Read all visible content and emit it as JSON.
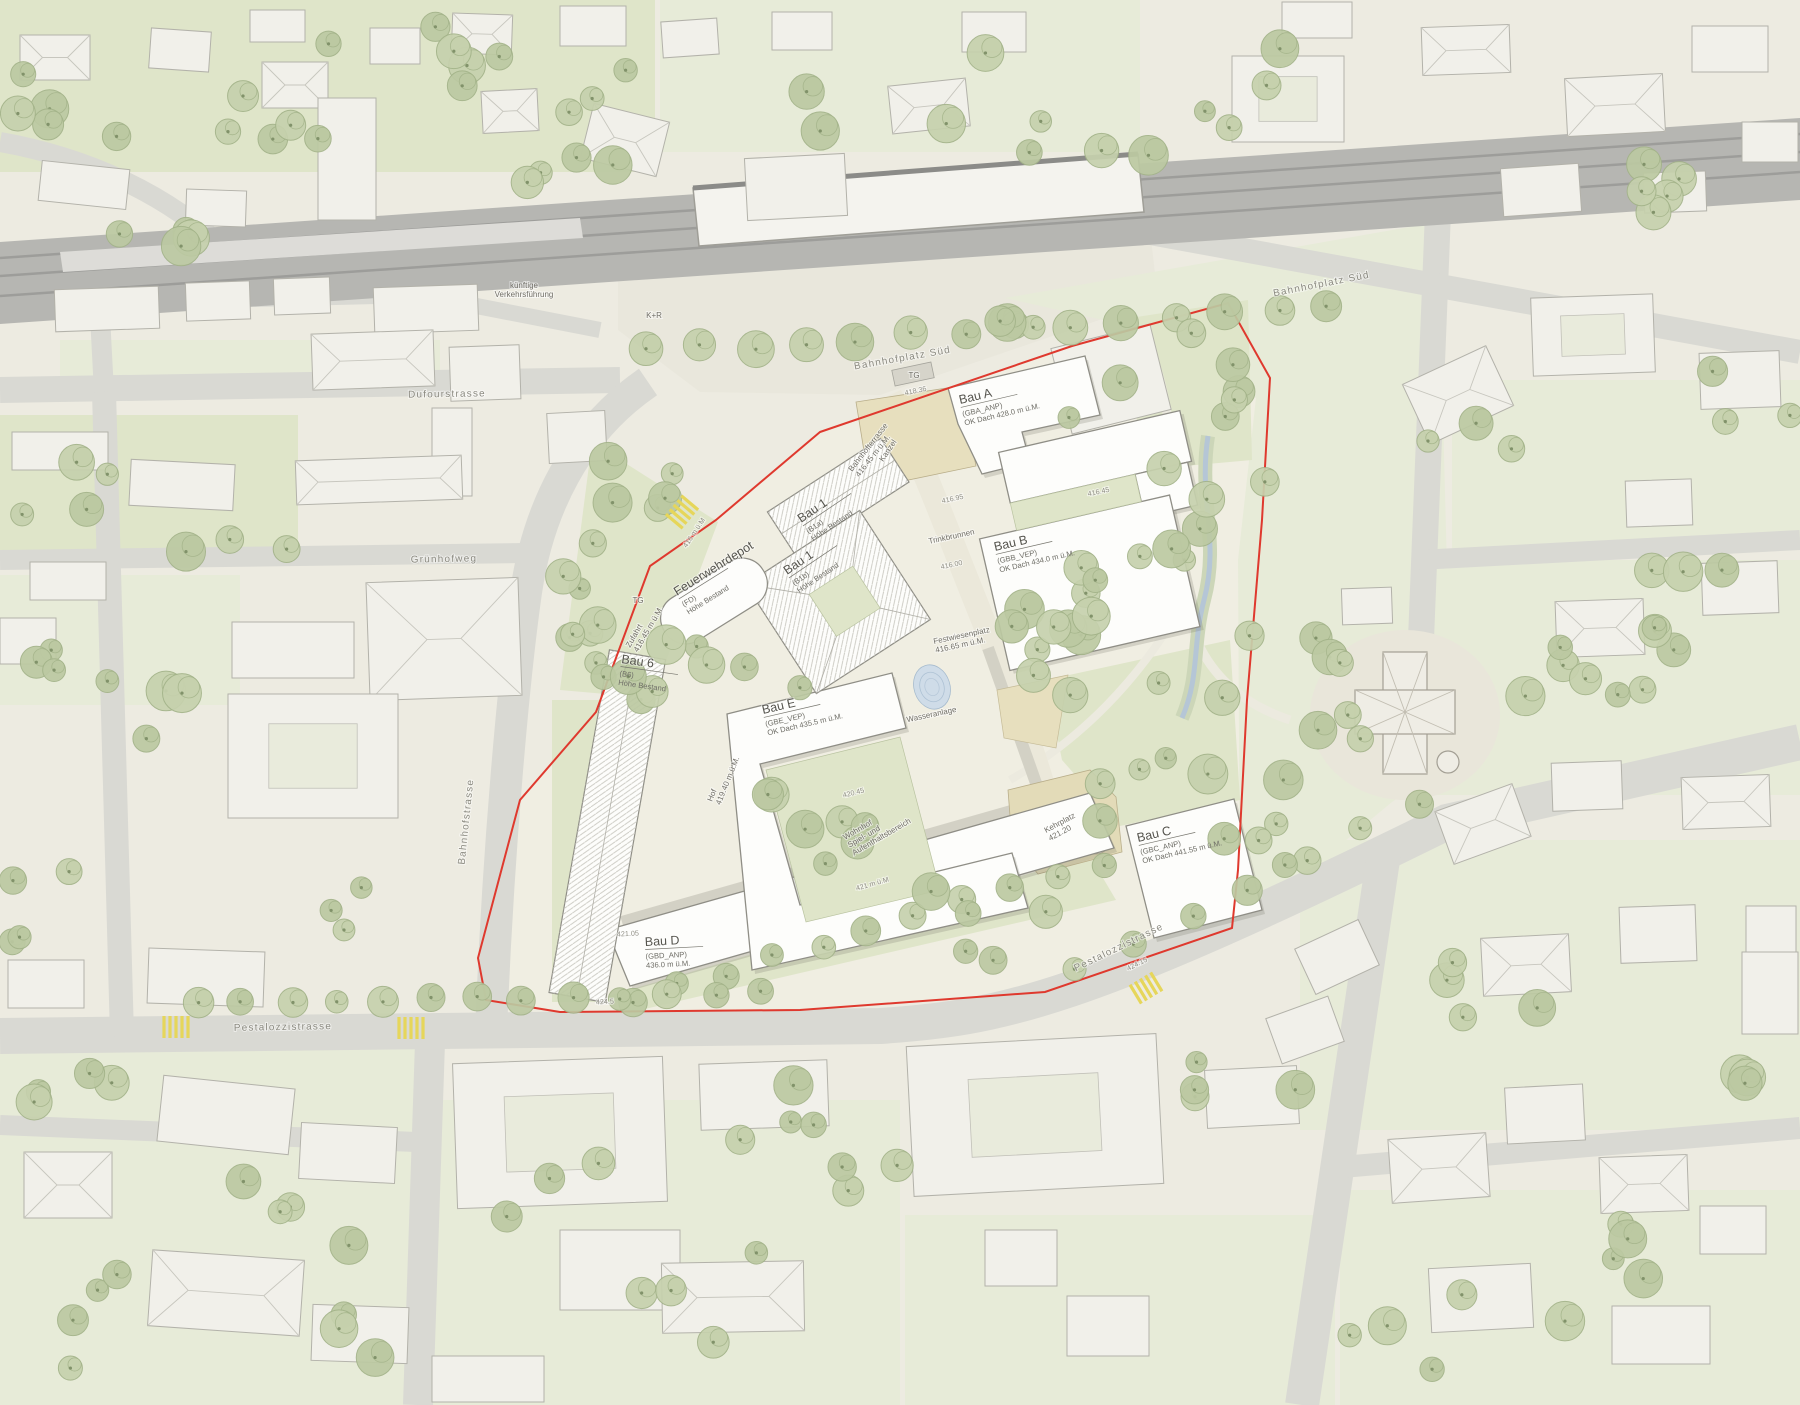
{
  "map": {
    "kind": "architectural-site-plan",
    "boundary_note": "site boundary shown as red line"
  },
  "colors": {
    "paper": "#edebe1",
    "green": "#dfe5c9",
    "green_light": "#e7ebd8",
    "street": "#d9d9d3",
    "railway": "#b6b6b2",
    "building_out": "#f1f0ea",
    "building_site": "#fdfdfb",
    "boundary_red": "#df392e",
    "tree_fill": "#c6d1ad",
    "tree_fill2": "#bcc9a2",
    "tree_edge": "#a3b389",
    "water": "#ccdbe9",
    "plaza_beige": "#e7dfbe",
    "text_dark": "#55544d",
    "text_mid": "#6e6d66",
    "text_light": "#8b8a80",
    "crossing_yellow": "#e6d65a"
  },
  "site_buildings": [
    {
      "id": "bau-a",
      "name": "Bau A",
      "code": "(GBA_ANP)",
      "height": "OK Dach 428.0 m ü.M.",
      "x": 960,
      "y": 404,
      "rot": -13
    },
    {
      "id": "bau-b",
      "name": "Bau B",
      "code": "(GBB_VEP)",
      "height": "OK Dach 434.0 m ü.M.",
      "x": 995,
      "y": 551,
      "rot": -13
    },
    {
      "id": "bau-c",
      "name": "Bau C",
      "code": "(GBC_ANP)",
      "height": "OK Dach 441.55 m ü.M.",
      "x": 1138,
      "y": 842,
      "rot": -13
    },
    {
      "id": "bau-d",
      "name": "Bau D",
      "code": "(GBD_ANP)",
      "height": "436.0 m ü.M.",
      "x": 645,
      "y": 946,
      "rot": -3
    },
    {
      "id": "bau-e",
      "name": "Bau E",
      "code": "(GBE_VEP)",
      "height": "OK Dach 435.5 m ü.M.",
      "x": 763,
      "y": 714,
      "rot": -13
    },
    {
      "id": "bau-1a",
      "name": "Bau 1",
      "code": "(B1a)",
      "height": "Höhe Bestand",
      "x": 801,
      "y": 523,
      "rot": -34
    },
    {
      "id": "bau-1b",
      "name": "Bau 1",
      "code": "(B1b)",
      "height": "Höhe Bestand",
      "x": 787,
      "y": 575,
      "rot": -34
    },
    {
      "id": "bau-6",
      "name": "Bau 6",
      "code": "(B6)",
      "height": "Höhe Bestand",
      "x": 621,
      "y": 663,
      "rot": 8
    },
    {
      "id": "feuerwehrdepot",
      "name": "Feuerwehrdepot",
      "code": "(FD)",
      "height": "Höhe Bestand",
      "x": 677,
      "y": 596,
      "rot": -32
    }
  ],
  "street_labels": [
    {
      "id": "dufourstrasse",
      "text": "Dufourstrasse",
      "x": 447,
      "y": 397,
      "rot": -1
    },
    {
      "id": "gruenhofweg",
      "text": "Grünhofweg",
      "x": 444,
      "y": 562,
      "rot": -1
    },
    {
      "id": "pestalozzistrasse-west",
      "text": "Pestalozzistrasse",
      "x": 283,
      "y": 1030,
      "rot": -1
    },
    {
      "id": "pestalozzistrasse-ost",
      "text": "Pestalozzistrasse",
      "x": 1120,
      "y": 950,
      "rot": -26
    },
    {
      "id": "bahnhofstrasse",
      "text": "Bahnhofstrasse",
      "x": 469,
      "y": 822,
      "rot": -84
    },
    {
      "id": "bahnhofplatz-sued",
      "text": "Bahnhofplatz Süd",
      "x": 903,
      "y": 361,
      "rot": -10
    },
    {
      "id": "bahnhofplatz-sued-ost",
      "text": "Bahnhofplatz Süd",
      "x": 1322,
      "y": 287,
      "rot": -11
    }
  ],
  "place_labels": [
    {
      "id": "kanzel",
      "lines": [
        "Kanzel"
      ],
      "x": 890,
      "y": 452,
      "rot": -56,
      "anchor": "middle"
    },
    {
      "id": "bahnhofterrasse",
      "lines": [
        "Bahnhofterrasse",
        "416.45 m ü.M."
      ],
      "x": 852,
      "y": 472,
      "rot": -52,
      "anchor": "start"
    },
    {
      "id": "trinkbrunnen",
      "lines": [
        "Trinkbrunnen"
      ],
      "x": 952,
      "y": 539,
      "rot": -12,
      "anchor": "middle"
    },
    {
      "id": "festwiesenplatz",
      "lines": [
        "Festwiesenplatz",
        "416.65 m ü.M."
      ],
      "x": 934,
      "y": 644,
      "rot": -12,
      "anchor": "start"
    },
    {
      "id": "wasseranlage",
      "lines": [
        "Wasseranlage"
      ],
      "x": 932,
      "y": 717,
      "rot": -12,
      "anchor": "middle"
    },
    {
      "id": "kehrplatz",
      "lines": [
        "Kehrplatz",
        "421.20"
      ],
      "x": 1046,
      "y": 833,
      "rot": -28,
      "anchor": "start"
    },
    {
      "id": "wohnhof",
      "lines": [
        "Wohnhof",
        "Spiel- und",
        "Aufenthaltsbereich"
      ],
      "x": 845,
      "y": 840,
      "rot": -30,
      "anchor": "start"
    },
    {
      "id": "zufahrt",
      "lines": [
        "Zufahrt",
        "416.45 m ü.M."
      ],
      "x": 630,
      "y": 648,
      "rot": -60,
      "anchor": "start"
    },
    {
      "id": "hof",
      "lines": [
        "Hof",
        "419.40 m ü.M."
      ],
      "x": 712,
      "y": 802,
      "rot": -68,
      "anchor": "start"
    },
    {
      "id": "tg-nord",
      "lines": [
        "TG"
      ],
      "x": 914,
      "y": 378,
      "rot": 0,
      "anchor": "middle"
    },
    {
      "id": "tg-west",
      "lines": [
        "TG"
      ],
      "x": 638,
      "y": 603,
      "rot": 0,
      "anchor": "middle"
    },
    {
      "id": "kiss-and-ride",
      "lines": [
        "K+R"
      ],
      "x": 654,
      "y": 318,
      "rot": 0,
      "anchor": "middle"
    },
    {
      "id": "kuenftige-verkehrsfuehrung",
      "lines": [
        "künftige",
        "Verkehrsführung"
      ],
      "x": 524,
      "y": 288,
      "rot": 0,
      "anchor": "middle"
    }
  ],
  "elevation_labels": [
    {
      "text": "418.36",
      "x": 916,
      "y": 393,
      "rot": -12
    },
    {
      "text": "416.95",
      "x": 953,
      "y": 501,
      "rot": -12
    },
    {
      "text": "416.00",
      "x": 952,
      "y": 567,
      "rot": -12
    },
    {
      "text": "416.45",
      "x": 1099,
      "y": 494,
      "rot": -12
    },
    {
      "text": "416 m ü.M",
      "x": 696,
      "y": 534,
      "rot": -56
    },
    {
      "text": "420.45",
      "x": 854,
      "y": 795,
      "rot": -14
    },
    {
      "text": "421 m ü.M",
      "x": 873,
      "y": 886,
      "rot": -16
    },
    {
      "text": "421.05",
      "x": 628,
      "y": 936,
      "rot": -3
    },
    {
      "text": "424.5",
      "x": 605,
      "y": 1004,
      "rot": -3
    },
    {
      "text": "424.15",
      "x": 1138,
      "y": 966,
      "rot": -26
    }
  ]
}
